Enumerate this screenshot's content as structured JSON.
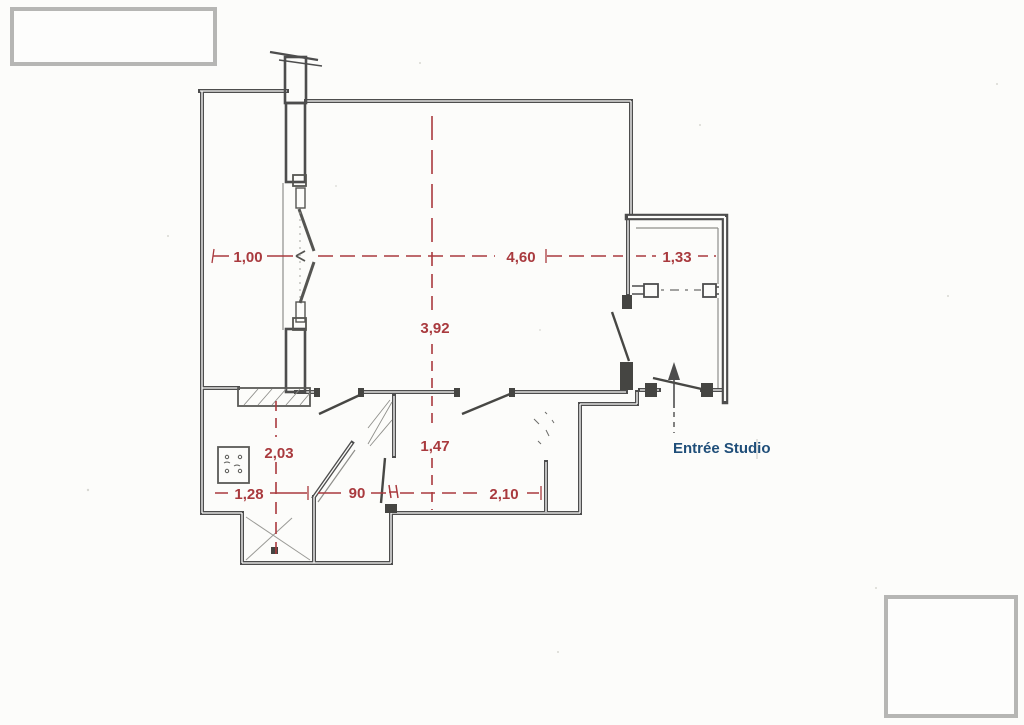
{
  "document": {
    "type": "hand-drawn studio floor plan sketch",
    "colors": {
      "paper": "#fcfcfa",
      "pencil": "#4d4d4d",
      "dimension_red": "#a93a3e",
      "label_blue": "#1f4e79",
      "placeholder_gray": "#b6b6b4"
    }
  },
  "labels": {
    "entrance": "Entrée Studio"
  },
  "dimensions": {
    "balcony_width": "1,00",
    "living_width": "4,60",
    "entry_width": "1,33",
    "living_depth": "3,92",
    "kitchen_depth": "2,03",
    "hall_depth": "1,47",
    "kitchen_width": "1,28",
    "door_width": "90",
    "corridor_width": "2,10"
  }
}
